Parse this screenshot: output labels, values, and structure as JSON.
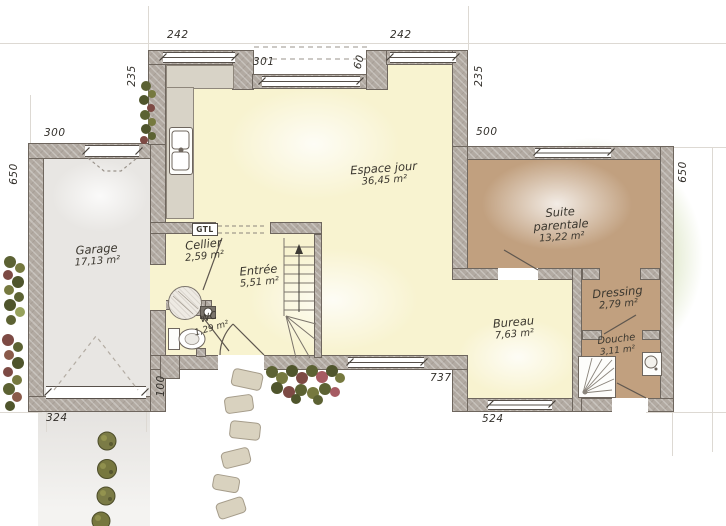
{
  "plan": {
    "type": "architectural-floor-plan",
    "rooms": [
      {
        "name": "Garage",
        "area": "17,13 m²"
      },
      {
        "name": "Cellier",
        "area": "2,59 m²"
      },
      {
        "name": "Entrée",
        "area": "5,51 m²"
      },
      {
        "name": "WC",
        "area": "1,29 m²"
      },
      {
        "name": "Espace jour",
        "area": "36,45 m²"
      },
      {
        "name": "Bureau",
        "area": "7,63 m²"
      },
      {
        "name": "Suite parentale",
        "area": "13,22 m²"
      },
      {
        "name": "Dressing",
        "area": "2,79 m²"
      },
      {
        "name": "Douche",
        "area": "3,11 m²"
      }
    ],
    "labels": {
      "gtl": "GTL"
    },
    "dims": {
      "window_top_left": "242",
      "bay_width": "301",
      "bay_depth": "60",
      "window_top_right": "242",
      "side_left_top": "235",
      "side_right_top": "235",
      "garage_top": "300",
      "garage_side_left": "650",
      "suite_top": "500",
      "suite_side_right": "650",
      "garage_bottom": "324",
      "porch_depth": "100",
      "facade_bottom": "737",
      "bureau_bottom": "524"
    },
    "colors": {
      "wall": "#b2aaa2",
      "wall_edge": "#6e665e",
      "floor_day": "#f8f3d0",
      "floor_night": "#c1a07f",
      "floor_garage": "#e8e6e3",
      "counter": "#d8d3c7",
      "window_line": "#57504a",
      "garden": "#d1ddb2",
      "text": "#3b372f"
    }
  }
}
